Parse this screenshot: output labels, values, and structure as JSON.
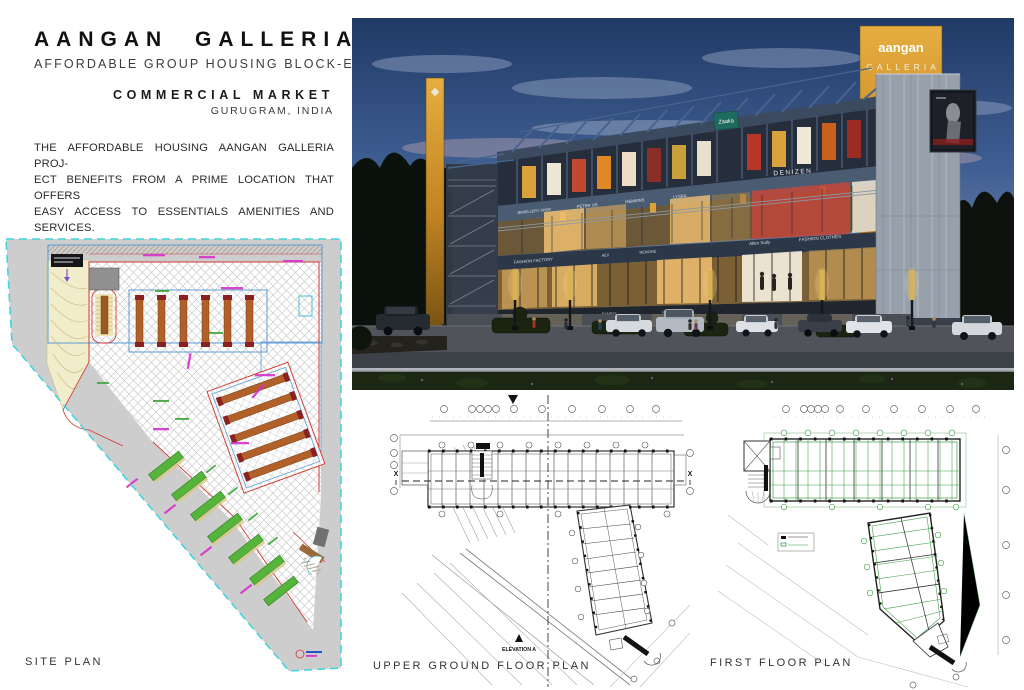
{
  "header": {
    "title": "AANGAN GALLERIA",
    "subtitle": "AFFORDABLE GROUP HOUSING BLOCK-E",
    "market_line": "COMMERCIAL MARKET",
    "location": "GURUGRAM, INDIA",
    "description_lines": [
      "THE AFFORDABLE HOUSING AANGAN GALLERIA PROJ-",
      "ECT BENEFITS FROM A PRIME LOCATION THAT OFFERS",
      "EASY ACCESS TO ESSENTIALS AMENITIES AND SERVICES.",
      "THE SORROUNDING NEIGHBORHOOD IS KNOWN FOR ITS",
      "DIVERSE COMMUNITY AND VIBRANT ATMOSPHERE CRE-",
      "ATING A WELCOMING ENVIRONMENT FOR RESIDENTS TO",
      "THRIVE."
    ]
  },
  "labels": {
    "site_plan": "SITE PLAN",
    "upper_ground_plan": "UPPER GROUND FLOOR PLAN",
    "first_floor_plan": "FIRST FLOOR PLAN",
    "elevation_marker": "ELEVATION A",
    "section_marker": "X"
  },
  "rendering": {
    "pylon_sign": {
      "line1": "aangan",
      "line2": "GALLERIA"
    },
    "banner_sign": "Zaaka",
    "shop_signs_upper": [
      "JEWELLERY SHOP",
      "PETER US",
      "HEMKINS",
      "LYSRA"
    ],
    "denizen_sign": "DENIZEN",
    "shop_signs_lower": [
      "FASHION FACTORY",
      "AEX",
      "REMONE",
      "Allen Solly",
      "FASHION CLOTHES"
    ],
    "shop_signs_base": [
      "PETER US",
      "BANGUI",
      "UTSAV"
    ]
  },
  "colors": {
    "accent_gold": "#d99b2e",
    "fascia_blue": "#4a5c72",
    "boundary_cyan": "#3fd6de",
    "site_red": "#cf3a33",
    "site_blue": "#5b9bd5",
    "site_magenta": "#d633c9",
    "green_bar": "#55b53a",
    "plan_green": "#3f9e43",
    "zaaka_teal": "#1e6a5e"
  }
}
